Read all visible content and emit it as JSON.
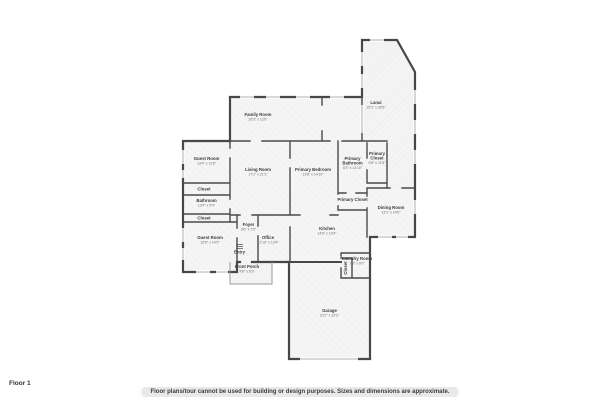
{
  "page": {
    "floor_label": "Floor 1",
    "disclaimer": "Floor plans/tour cannot be used for building or design purposes. Sizes and dimensions are approximate."
  },
  "colors": {
    "wall": "#474747",
    "room_fill": "#f5f5f5",
    "hatch_line": "#e9e9e9",
    "window_line": "#999999",
    "room_name_text": "#3a3a3a",
    "room_dims_text": "#6e6e6e"
  },
  "rooms": [
    {
      "id": "family-room",
      "name": "Family Room",
      "dims": "26'3\" x 12'6\"",
      "x": 258,
      "y": 116
    },
    {
      "id": "lanai",
      "name": "Lanai",
      "dims": "15'1\" x 29'5\"",
      "x": 376,
      "y": 104
    },
    {
      "id": "guest-room-a",
      "name": "Guest Room",
      "dims": "13'4\" x 11'8\"",
      "x": 206.5,
      "y": 160
    },
    {
      "id": "living-room",
      "name": "Living Room",
      "dims": "17'1\" x 21'1\"",
      "x": 258,
      "y": 171
    },
    {
      "id": "primary-bedroom",
      "name": "Primary Bedroom",
      "dims": "13'8\" x 14'10\"",
      "x": 313,
      "y": 171
    },
    {
      "id": "primary-bathroom",
      "name": "Primary",
      "name2": "Bathroom",
      "dims": "8'3\" x 14'10\"",
      "x": 352.5,
      "y": 160
    },
    {
      "id": "primary-closet",
      "name": "Primary",
      "name2": "Closet",
      "dims": "5'8\" x 11'5\"",
      "x": 377,
      "y": 155
    },
    {
      "id": "primary-closet-2",
      "name": "Primary Closet",
      "x": 352.5,
      "y": 201
    },
    {
      "id": "dining-room",
      "name": "Dining Room",
      "dims": "13'1\" x 14'0\"",
      "x": 391,
      "y": 209
    },
    {
      "id": "closet-a",
      "name": "Closet",
      "x": 204,
      "y": 190.5
    },
    {
      "id": "bathroom",
      "name": "Bathroom",
      "dims": "13'4\" x 5'4\"",
      "x": 206.5,
      "y": 202
    },
    {
      "id": "closet-b",
      "name": "Closet",
      "x": 204,
      "y": 219.5
    },
    {
      "id": "guest-room-b",
      "name": "Guest Room",
      "dims": "15'5\" x 14'3\"",
      "x": 210,
      "y": 239
    },
    {
      "id": "foyer",
      "name": "Foyer",
      "dims": "6'6\" x 7'5\"",
      "x": 248.5,
      "y": 226
    },
    {
      "id": "entry",
      "name": "Entry",
      "x": 239.5,
      "y": 253.5
    },
    {
      "id": "front-porch",
      "name": "Front Porch",
      "dims": "9'8\" x 6'3\"",
      "x": 247,
      "y": 268
    },
    {
      "id": "office",
      "name": "Office",
      "dims": "12'10\" x 13'4\"",
      "x": 268,
      "y": 239
    },
    {
      "id": "kitchen",
      "name": "Kitchen",
      "dims": "14'6\" x 13'4\"",
      "x": 327,
      "y": 230
    },
    {
      "id": "laundry-room",
      "name": "Laundry Room",
      "dims": "7'8\" x 6'0\"",
      "x": 357,
      "y": 260
    },
    {
      "id": "laundry-closet",
      "name": "Closet",
      "x": 347,
      "y": 268,
      "rotate": true
    },
    {
      "id": "garage",
      "name": "Garage",
      "dims": "23'1\" x 23'2\"",
      "x": 329.5,
      "y": 312
    }
  ]
}
